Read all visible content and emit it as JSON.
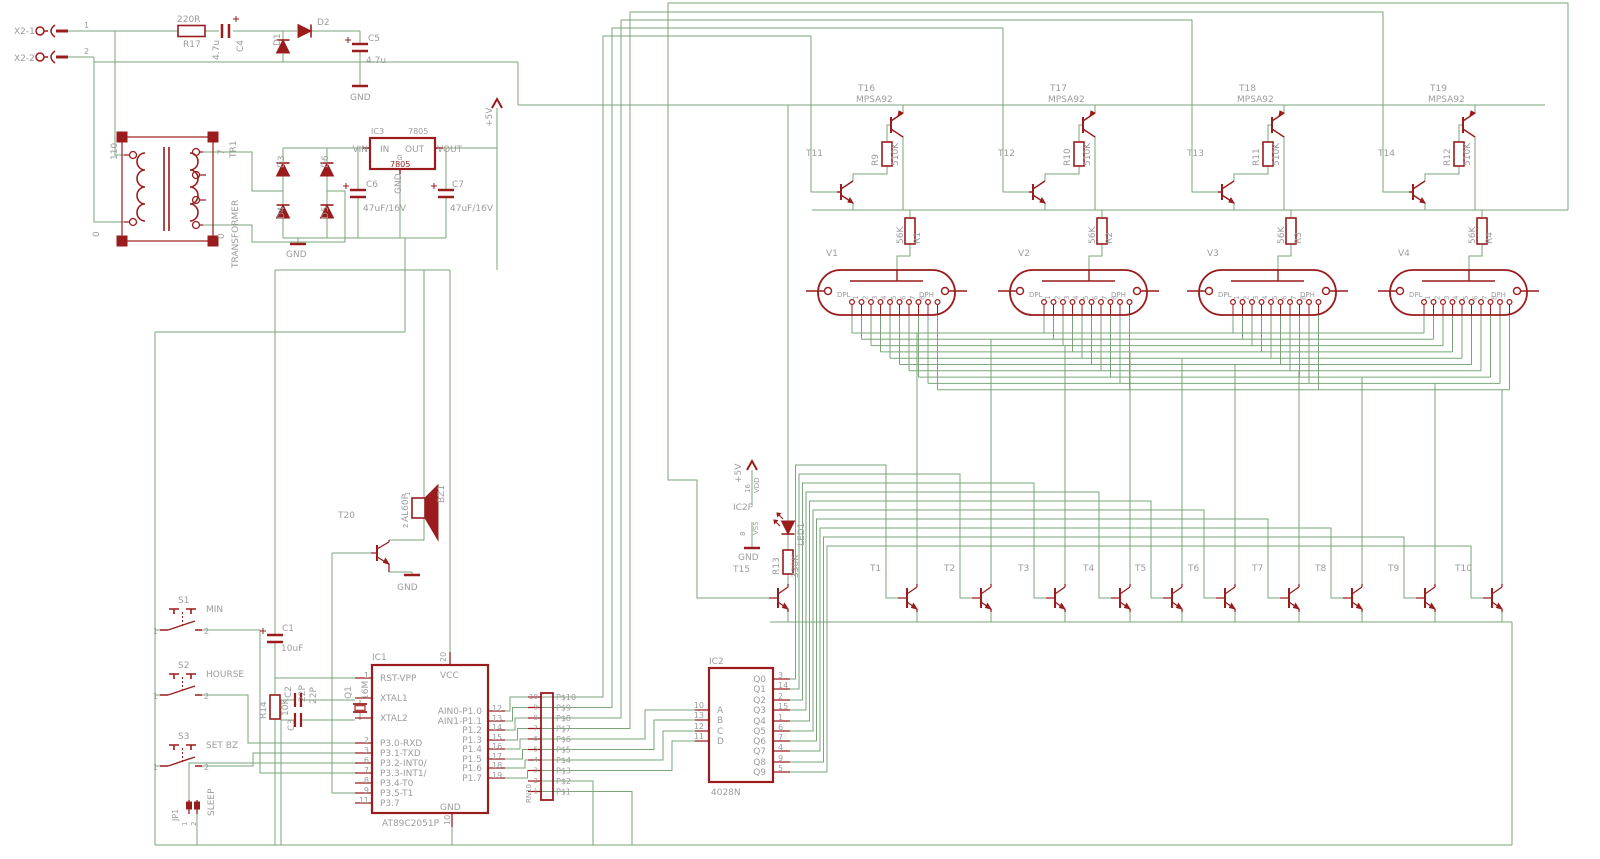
{
  "colors": {
    "wire": "#7aa67a",
    "part": "#9a1c1c",
    "label": "#9c9c9c",
    "background": "#ffffff"
  },
  "power_input": {
    "x2_1": "X2-1",
    "x2_2": "X2-2",
    "pin1": "1",
    "pin2": "2",
    "r17": "R17",
    "r17_value": "220R",
    "c4": "C4",
    "c4_value": "4.7u",
    "d1": "D1",
    "d2": "D2",
    "c5": "C5",
    "c5_value": "4.7u",
    "gnd": "GND"
  },
  "transformer": {
    "name": "TR1",
    "label": "TRANSFORMER",
    "prim": "110",
    "prim0": "0",
    "sec": "7",
    "sec0": "0"
  },
  "bridge": {
    "d3": "D3",
    "d4": "D4",
    "d5": "D5",
    "d6": "D6",
    "gnd": "GND"
  },
  "regulator": {
    "name": "IC3",
    "part": "7805",
    "vin": "VIN",
    "vout": "VOUT",
    "pin_in": "IN",
    "pin_out": "OUT",
    "g": "G",
    "value": "7805",
    "gnd": "GND"
  },
  "caps": {
    "c6": "C6",
    "c6_value": "47uF/16V",
    "c7": "C7",
    "c7_value": "47uF/16V"
  },
  "rails": {
    "plus5v": "+5V"
  },
  "drivers": {
    "labels": [
      "T16",
      "T17",
      "T18",
      "T19"
    ],
    "part": "MPSA92",
    "r_top": [
      "R9",
      "R10",
      "R11",
      "R12"
    ],
    "r_top_value": "510K",
    "t_mid": [
      "T11",
      "T12",
      "T13",
      "T14"
    ],
    "r_bot": [
      "R1",
      "R2",
      "R3",
      "R4"
    ],
    "r_bot_value": "56K",
    "tubes": [
      "V1",
      "V2",
      "V3",
      "V4"
    ],
    "tube_pins": {
      "dpl": "DPL",
      "digits": [
        "1",
        "2",
        "3",
        "4",
        "5",
        "6",
        "7",
        "8"
      ],
      "dph": "DPH"
    }
  },
  "digit_transistors": [
    "T1",
    "T2",
    "T3",
    "T4",
    "T5",
    "T6",
    "T7",
    "T8",
    "T9",
    "T10"
  ],
  "led_block": {
    "plus5v": "+5V",
    "vdd_num": "16",
    "vdd": "VDD",
    "name": "IC2P",
    "vss_num": "8",
    "vss": "VSS",
    "gnd": "GND",
    "t15": "T15",
    "led": "LED1",
    "r13": "R13",
    "r13_value": "330K"
  },
  "buzzer": {
    "t20": "T20",
    "bz1": "BZ1",
    "part": "AL60P",
    "pin1": "1",
    "pin2": "2",
    "gnd": "GND"
  },
  "reset": {
    "c1": "C1",
    "c1_value": "10uF",
    "r14": "R14",
    "r14_value": "10K"
  },
  "xtal": {
    "c2": "C2",
    "c2_value": "22P",
    "c3": "C3",
    "c3_value": "22P",
    "q1": "Q1",
    "q1_value": "16M"
  },
  "mcu": {
    "name": "IC1",
    "part": "AT89C2051P",
    "vcc": "VCC",
    "vcc_num": "20",
    "gnd": "GND",
    "gnd_num": "10",
    "left_pins": [
      {
        "num": "1",
        "label": "RST-VPP"
      },
      {
        "num": "",
        "label": "XTAL1"
      },
      {
        "num": "",
        "label": "XTAL2"
      },
      {
        "num": "2",
        "label": "P3.0-RXD"
      },
      {
        "num": "3",
        "label": "P3.1-TXD"
      },
      {
        "num": "6",
        "label": "P3.2-INT0/"
      },
      {
        "num": "7",
        "label": "P3.3-INT1/"
      },
      {
        "num": "8",
        "label": "P3.4-T0"
      },
      {
        "num": "9",
        "label": "P3.5-T1"
      },
      {
        "num": "11",
        "label": "P3.7"
      }
    ],
    "right_pins": [
      {
        "num": "12",
        "label": "AIN0-P1.0"
      },
      {
        "num": "13",
        "label": "AIN1-P1.1"
      },
      {
        "num": "14",
        "label": "P1.2"
      },
      {
        "num": "15",
        "label": "P1.3"
      },
      {
        "num": "16",
        "label": "P1.4"
      },
      {
        "num": "17",
        "label": "P1.5"
      },
      {
        "num": "18",
        "label": "P1.6"
      },
      {
        "num": "19",
        "label": "P1.7"
      }
    ]
  },
  "network": {
    "name": "RN10",
    "pins": [
      {
        "num": "10",
        "label": "P$10"
      },
      {
        "num": "9",
        "label": "P$9"
      },
      {
        "num": "8",
        "label": "P$8"
      },
      {
        "num": "7",
        "label": "P$7"
      },
      {
        "num": "6",
        "label": "P$6"
      },
      {
        "num": "5",
        "label": "P$5"
      },
      {
        "num": "4",
        "label": "P$4"
      },
      {
        "num": "3",
        "label": "P$3"
      },
      {
        "num": "2",
        "label": "P$2"
      },
      {
        "num": "1",
        "label": "P$1"
      }
    ]
  },
  "decoder": {
    "name": "IC2",
    "part": "4028N",
    "inputs": [
      {
        "num": "10",
        "label": "A"
      },
      {
        "num": "13",
        "label": "B"
      },
      {
        "num": "12",
        "label": "C"
      },
      {
        "num": "11",
        "label": "D"
      }
    ],
    "outputs": [
      {
        "num": "3",
        "label": "Q0"
      },
      {
        "num": "14",
        "label": "Q1"
      },
      {
        "num": "2",
        "label": "Q2"
      },
      {
        "num": "15",
        "label": "Q3"
      },
      {
        "num": "1",
        "label": "Q4"
      },
      {
        "num": "6",
        "label": "Q5"
      },
      {
        "num": "7",
        "label": "Q6"
      },
      {
        "num": "4",
        "label": "Q7"
      },
      {
        "num": "9",
        "label": "Q8"
      },
      {
        "num": "5",
        "label": "Q9"
      }
    ]
  },
  "switches": [
    {
      "name": "S1",
      "func": "MIN",
      "p1": "1",
      "p2": "2"
    },
    {
      "name": "S2",
      "func": "HOURSE",
      "p1": "1",
      "p2": "2"
    },
    {
      "name": "S3",
      "func": "SET BZ",
      "p1": "1",
      "p2": "2"
    }
  ],
  "jumper": {
    "name": "JP1",
    "func": "SLEEP",
    "p1": "1",
    "p2": "2"
  }
}
